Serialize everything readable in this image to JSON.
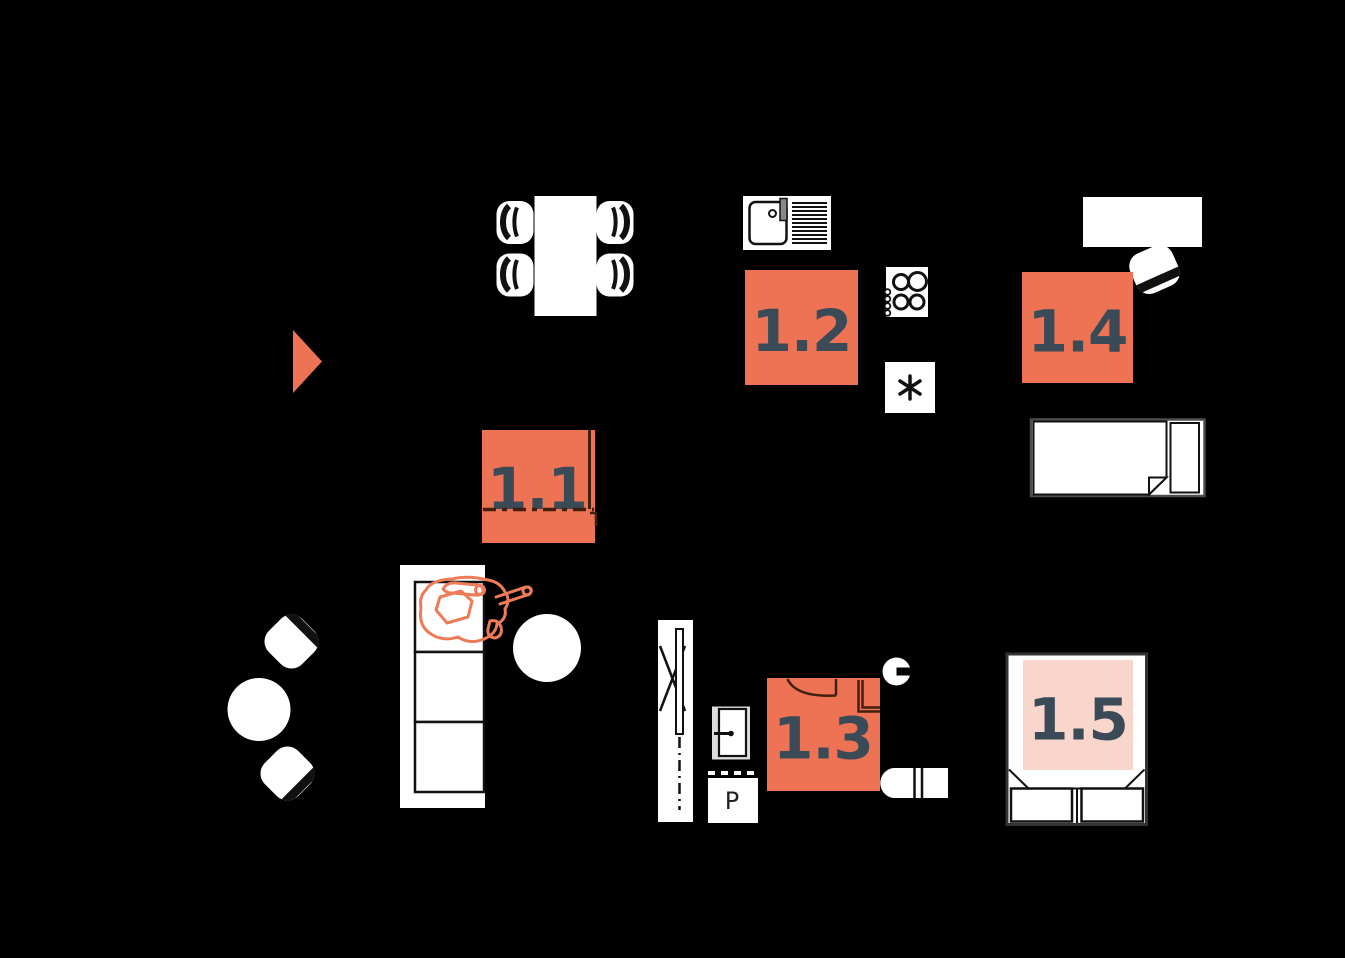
{
  "app": {
    "type": "apartment-floor-plan",
    "background": "#000000"
  },
  "palette": {
    "accent": "#ED7354",
    "accent_light": "#F9D6CC",
    "label_text": "#3A4B57",
    "figure_outline": "#EE7B57",
    "furniture_fill": "#FFFFFF",
    "plan_line_on_accent": "#41200F"
  },
  "rooms": {
    "r11": {
      "label": "1.1"
    },
    "r12": {
      "label": "1.2"
    },
    "r13": {
      "label": "1.3"
    },
    "r14": {
      "label": "1.4"
    },
    "r15": {
      "label": "1.5"
    },
    "pantry": {
      "label": "P"
    }
  },
  "icons": [
    "entrance-arrow-icon",
    "dining-table-icon",
    "dining-chair-icon",
    "kitchen-sink-icon",
    "hob-icon",
    "fridge-icon",
    "desk-icon",
    "desk-chair-icon",
    "single-bed-icon",
    "sofa-icon",
    "person-figure-icon",
    "coffee-table-icon",
    "bistro-table-icon",
    "bistro-chair-icon",
    "wardrobe-icon",
    "interior-door-icon",
    "pantry-box",
    "washbasin-icon",
    "toilet-icon",
    "double-bed-icon"
  ]
}
